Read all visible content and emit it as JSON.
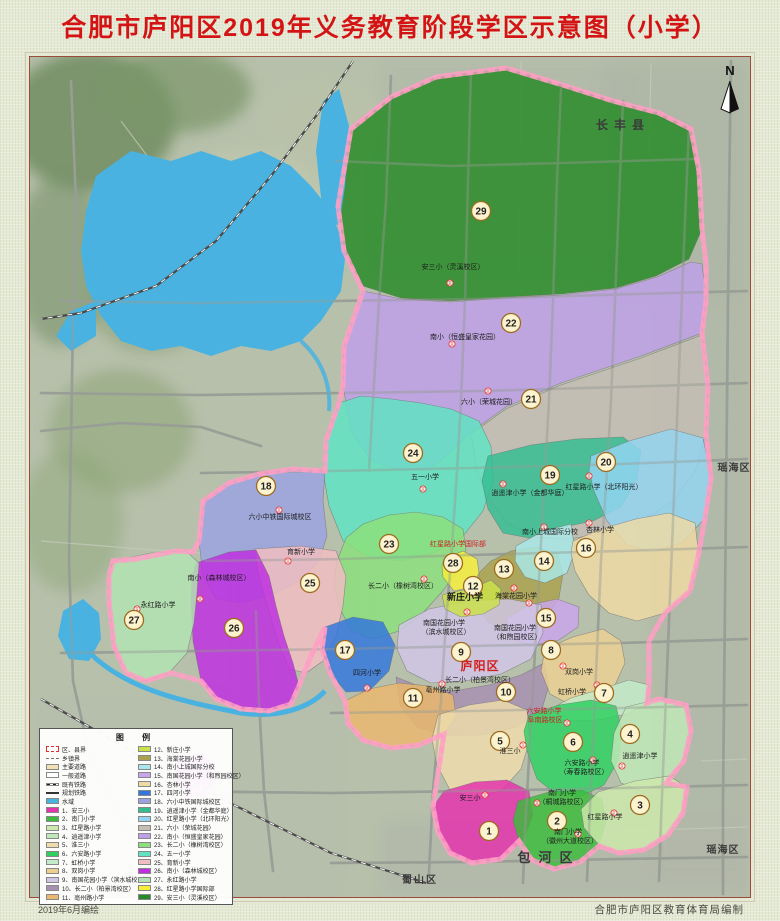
{
  "title": "合肥市庐阳区2019年义务教育阶段学区示意图（小学）",
  "compass_label": "N",
  "footer": {
    "left": "2019年6月编绘",
    "right": "合肥市庐阳区教育体育局编制"
  },
  "legend": {
    "title": "图  例",
    "symbols": [
      {
        "type": "boundary",
        "label": "区、县界"
      },
      {
        "type": "township",
        "label": "乡镇界"
      },
      {
        "type": "major-road",
        "label": "主要道路"
      },
      {
        "type": "minor-road",
        "label": "一般道路"
      },
      {
        "type": "railway",
        "label": "既有铁路"
      },
      {
        "type": "planned-railway",
        "label": "规划铁路"
      },
      {
        "type": "water",
        "label": "水域"
      }
    ],
    "schools": [
      {
        "no": 1,
        "name": "安三小",
        "color": "#e532ae"
      },
      {
        "no": 2,
        "name": "南门小学",
        "color": "#3dbb3d"
      },
      {
        "no": 3,
        "name": "红星路小学",
        "color": "#cde8ac"
      },
      {
        "no": 4,
        "name": "逍遥津小学",
        "color": "#bfe8b8"
      },
      {
        "no": 5,
        "name": "淮三小",
        "color": "#eedcab"
      },
      {
        "no": 6,
        "name": "六安路小学",
        "color": "#2fd060"
      },
      {
        "no": 7,
        "name": "虹桥小学",
        "color": "#c2ecc8"
      },
      {
        "no": 8,
        "name": "双岗小学",
        "color": "#ecd092"
      },
      {
        "no": 9,
        "name": "南国花园小学（滨水城校区）",
        "color": "#cfc6e6"
      },
      {
        "no": 10,
        "name": "长二小（柏景湾校区）",
        "color": "#a78fb0"
      },
      {
        "no": 11,
        "name": "亳州路小学",
        "color": "#eab86e"
      },
      {
        "no": 12,
        "name": "新庄小学",
        "color": "#cbe14a"
      },
      {
        "no": 13,
        "name": "海棠花园小学",
        "color": "#aaa24e"
      },
      {
        "no": 14,
        "name": "南小上城国际分校",
        "color": "#a8e8e8"
      },
      {
        "no": 15,
        "name": "南国花园小学（和煦园校区）",
        "color": "#c9a6ec"
      },
      {
        "no": 16,
        "name": "杏林小学",
        "color": "#eedaa4"
      },
      {
        "no": 17,
        "name": "四河小学",
        "color": "#3377dd"
      },
      {
        "no": 18,
        "name": "六小中铁国际城校区",
        "color": "#9aa3e0"
      },
      {
        "no": 19,
        "name": "逍遥津小学（金都华庭）",
        "color": "#35bd92"
      },
      {
        "no": 20,
        "name": "红星路小学（北环阳光）",
        "color": "#92d4f2"
      },
      {
        "no": 21,
        "name": "六小（荣城花园）",
        "color": "#c5beb4"
      },
      {
        "no": 22,
        "name": "南小（恒盛皇家花园）",
        "color": "#bfa0e8"
      },
      {
        "no": 23,
        "name": "长二小（橡树湾校区）",
        "color": "#8ce07c"
      },
      {
        "no": 24,
        "name": "五一小学",
        "color": "#5fe3c3"
      },
      {
        "no": 25,
        "name": "育新小学",
        "color": "#f2bdc2"
      },
      {
        "no": 26,
        "name": "南小（森林城校区）",
        "color": "#bf2fe0"
      },
      {
        "no": 27,
        "name": "永红路小学",
        "color": "#b2e3b2"
      },
      {
        "no": 28,
        "name": "红星路小学国际部",
        "color": "#f5ef3a"
      },
      {
        "no": 29,
        "name": "安三小（灵溪校区）",
        "color": "#268a26"
      }
    ]
  },
  "map_labels": [
    {
      "id": "l29",
      "text": "安三小（灵溪校区）"
    },
    {
      "id": "l22",
      "text": "南小（恒盛皇家花园）"
    },
    {
      "id": "l21",
      "text": "六小（荣城花园）"
    },
    {
      "id": "l24",
      "text": "五一小学"
    },
    {
      "id": "l18",
      "text": "六小中铁国际城校区"
    },
    {
      "id": "l19",
      "text": "逍遥津小学（金都华庭）"
    },
    {
      "id": "l20",
      "text": "红星路小学（北环阳光）"
    },
    {
      "id": "l14",
      "text": "南小上城国际分校"
    },
    {
      "id": "l16",
      "text": "杏林小学"
    },
    {
      "id": "l23",
      "text": "长二小（橡树湾校区）"
    },
    {
      "id": "l28",
      "text": "红星路小学国际部",
      "color": "#cf1f1f"
    },
    {
      "id": "l12",
      "text": "新庄小学",
      "bold": true,
      "size": 9
    },
    {
      "id": "l13",
      "text": "海棠花园小学"
    },
    {
      "id": "l9a",
      "text": "南国花园小学"
    },
    {
      "id": "l9b",
      "text": "（滨水城校区）"
    },
    {
      "id": "l15a",
      "text": "南国花园小学"
    },
    {
      "id": "l15b",
      "text": "（和煦园校区）"
    },
    {
      "id": "l8",
      "text": "双岗小学"
    },
    {
      "id": "l7",
      "text": "虹桥小学"
    },
    {
      "id": "l10",
      "text": "长二小（柏景湾校区）"
    },
    {
      "id": "l11",
      "text": "亳州路小学"
    },
    {
      "id": "l17",
      "text": "四河小学"
    },
    {
      "id": "l6a",
      "text": "六安路小学",
      "color": "#cf1f1f"
    },
    {
      "id": "l6b",
      "text": "阜南路校区",
      "color": "#cf1f1f"
    },
    {
      "id": "l6c",
      "text": "六安路小学"
    },
    {
      "id": "l6d",
      "text": "（寿春路校区）"
    },
    {
      "id": "l4",
      "text": "逍遥津小学"
    },
    {
      "id": "l5",
      "text": "淮三小"
    },
    {
      "id": "l1",
      "text": "安三小"
    },
    {
      "id": "l2a",
      "text": "南门小学"
    },
    {
      "id": "l2b",
      "text": "（桐城路校区）"
    },
    {
      "id": "l2c",
      "text": "南门小学"
    },
    {
      "id": "l2d",
      "text": "（徽州大道校区）"
    },
    {
      "id": "l3",
      "text": "红星路小学"
    },
    {
      "id": "l25",
      "text": "育新小学"
    },
    {
      "id": "l26",
      "text": "南小（森林城校区）"
    },
    {
      "id": "l27",
      "text": "永红路小学"
    }
  ],
  "districts": [
    {
      "id": "changfeng",
      "name": "长丰县"
    },
    {
      "id": "yaohai_e",
      "name": "瑶海区"
    },
    {
      "id": "yaohai_s",
      "name": "瑶海区"
    },
    {
      "id": "baohe",
      "name": "包河区"
    },
    {
      "id": "shushan",
      "name": "蜀山区"
    },
    {
      "id": "luyang",
      "name": "庐阳区"
    }
  ]
}
